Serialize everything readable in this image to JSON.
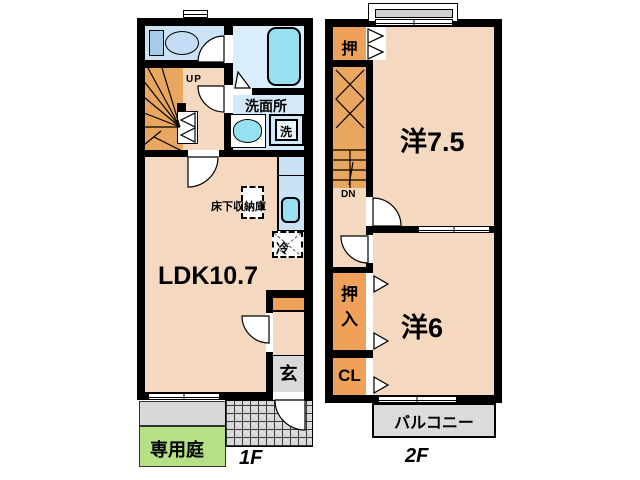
{
  "floor1": {
    "floor_label": "1F",
    "up": "UP",
    "washroom": "洗面所",
    "laundry": "洗",
    "underfloor_storage": "床下収納庫",
    "fridge": "冷",
    "ldk": "LDK10.7",
    "entrance": "玄",
    "garden": "専用庭"
  },
  "floor2": {
    "floor_label": "2F",
    "closet_top": "押",
    "room_large": "洋7.5",
    "down": "DN",
    "oshiire_char1": "押",
    "oshiire_char2": "入",
    "cl": "CL",
    "room_small": "洋6",
    "balcony": "バルコニー"
  },
  "colors": {
    "wall": "#000000",
    "room_peach": "#F4D9C0",
    "closet_orange": "#F0A159",
    "stairs_orange": "#E9A65E",
    "washroom_blue": "#D3E8F8",
    "bathroom_blue": "#DAEDFA",
    "toilet_blue": "#CCE3F6",
    "kitchen_blue": "#C9E2F6",
    "fixture_cyan": "#97E0F1",
    "entrance_gray": "#D9D9D9",
    "garden_green": "#B5E085"
  }
}
